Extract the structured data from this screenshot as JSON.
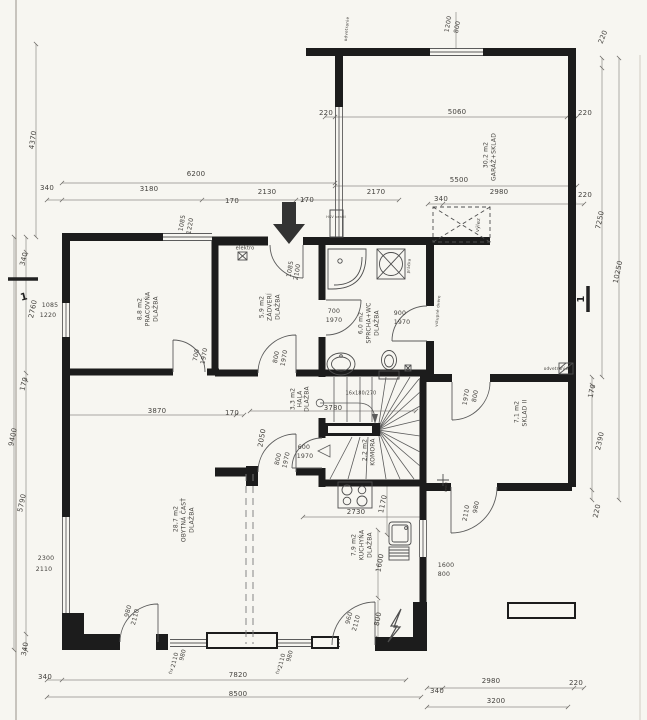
{
  "document": {
    "kind": "architectural-floor-plan"
  },
  "colors": {
    "paper": "#f7f6f1",
    "wall_ink": "#1c1c1c",
    "thin_line": "#5c5c5c",
    "dim_line": "#8f8d88",
    "text": "#44423e",
    "arrow": "#333333"
  },
  "labels": [
    {
      "name": "dim-1200-top",
      "kind": "dimension",
      "t": "1200",
      "x": 448,
      "y": 24,
      "r": -80,
      "s": 6.2
    },
    {
      "name": "dim-800-top",
      "kind": "dimension",
      "t": "800",
      "x": 457,
      "y": 27,
      "r": -80,
      "s": 6.2
    },
    {
      "name": "ann-odvetranie-top",
      "kind": "annotation",
      "t": "odvetranie",
      "x": 347,
      "y": 29,
      "r": -85,
      "s": 4.2
    },
    {
      "name": "dim-220-top-right",
      "kind": "dimension",
      "t": "220",
      "x": 603,
      "y": 37,
      "r": -68,
      "s": 7
    },
    {
      "name": "dim-4370",
      "kind": "dimension",
      "t": "4370",
      "x": 33,
      "y": 140,
      "r": -82,
      "s": 7
    },
    {
      "name": "dim-220-garage-left",
      "kind": "dimension",
      "t": "220",
      "x": 326,
      "y": 113,
      "r": 0,
      "s": 7
    },
    {
      "name": "dim-5060",
      "kind": "dimension",
      "t": "5060",
      "x": 457,
      "y": 112,
      "r": 0,
      "s": 7
    },
    {
      "name": "dim-220-garage-right",
      "kind": "dimension",
      "t": "220",
      "x": 585,
      "y": 113,
      "r": 0,
      "s": 7
    },
    {
      "name": "room-garaz-area",
      "kind": "room",
      "t": "30,2 m2",
      "x": 486,
      "y": 155,
      "r": -90,
      "s": 6
    },
    {
      "name": "room-garaz-name",
      "kind": "room",
      "t": "GARÁŽ+SKLAD",
      "x": 494,
      "y": 157,
      "r": -90,
      "s": 6
    },
    {
      "name": "dim-5500",
      "kind": "dimension",
      "t": "5500",
      "x": 459,
      "y": 180,
      "r": 0,
      "s": 7
    },
    {
      "name": "dim-6200",
      "kind": "dimension",
      "t": "6200",
      "x": 196,
      "y": 174,
      "r": 0,
      "s": 7
    },
    {
      "name": "dim-340-top-1",
      "kind": "dimension",
      "t": "340",
      "x": 47,
      "y": 188,
      "r": 0,
      "s": 7
    },
    {
      "name": "dim-3180",
      "kind": "dimension",
      "t": "3180",
      "x": 149,
      "y": 189,
      "r": 0,
      "s": 7
    },
    {
      "name": "dim-2130",
      "kind": "dimension",
      "t": "2130",
      "x": 267,
      "y": 192,
      "r": 0,
      "s": 7
    },
    {
      "name": "dim-170-top-1",
      "kind": "dimension",
      "t": "170",
      "x": 232,
      "y": 201,
      "r": 0,
      "s": 7
    },
    {
      "name": "dim-2170",
      "kind": "dimension",
      "t": "2170",
      "x": 376,
      "y": 192,
      "r": 0,
      "s": 7
    },
    {
      "name": "dim-170-top-2",
      "kind": "dimension",
      "t": "170",
      "x": 307,
      "y": 200,
      "r": 0,
      "s": 7
    },
    {
      "name": "dim-340-top-2",
      "kind": "dimension",
      "t": "340",
      "x": 441,
      "y": 199,
      "r": 0,
      "s": 7
    },
    {
      "name": "dim-2980-top",
      "kind": "dimension",
      "t": "2980",
      "x": 499,
      "y": 192,
      "r": 0,
      "s": 7
    },
    {
      "name": "dim-220-top-3",
      "kind": "dimension",
      "t": "220",
      "x": 585,
      "y": 195,
      "r": 0,
      "s": 7
    },
    {
      "name": "dim-7250",
      "kind": "dimension",
      "t": "7250",
      "x": 600,
      "y": 220,
      "r": -78,
      "s": 7
    },
    {
      "name": "dim-10250",
      "kind": "dimension",
      "t": "10250",
      "x": 618,
      "y": 272,
      "r": -78,
      "s": 7
    },
    {
      "name": "win-1085-top",
      "kind": "window-size",
      "t": "1085",
      "x": 182,
      "y": 223,
      "r": -80,
      "s": 6.2
    },
    {
      "name": "win-1220-top",
      "kind": "window-size",
      "t": "1220",
      "x": 190,
      "y": 226,
      "r": -80,
      "s": 6.2
    },
    {
      "name": "ann-hsv-ventil",
      "kind": "annotation",
      "t": "HSV ventil",
      "x": 336,
      "y": 217,
      "r": 0,
      "s": 3.4
    },
    {
      "name": "ann-vylez",
      "kind": "annotation",
      "t": "výlez",
      "x": 478,
      "y": 225,
      "r": -85,
      "s": 5
    },
    {
      "name": "ann-elektro",
      "kind": "annotation",
      "t": "elektro",
      "x": 245,
      "y": 248,
      "r": 0,
      "s": 5
    },
    {
      "name": "door-1085-vchod",
      "kind": "door-size",
      "t": "1085",
      "x": 290,
      "y": 269,
      "r": -80,
      "s": 6.2
    },
    {
      "name": "door-2100-vchod",
      "kind": "door-size",
      "t": "2100",
      "x": 297,
      "y": 272,
      "r": -80,
      "s": 6.2
    },
    {
      "name": "dim-340-left-1",
      "kind": "dimension",
      "t": "340",
      "x": 24,
      "y": 259,
      "r": -76,
      "s": 7
    },
    {
      "name": "dim-2760",
      "kind": "dimension",
      "t": "2760",
      "x": 33,
      "y": 309,
      "r": -78,
      "s": 7
    },
    {
      "name": "win-1085-left",
      "kind": "window-size",
      "t": "1085",
      "x": 50,
      "y": 305,
      "r": 0,
      "s": 6.2
    },
    {
      "name": "win-1220-left",
      "kind": "window-size",
      "t": "1220",
      "x": 48,
      "y": 315,
      "r": 0,
      "s": 6.2
    },
    {
      "name": "dim-170-left",
      "kind": "dimension",
      "t": "170",
      "x": 24,
      "y": 384,
      "r": -76,
      "s": 7
    },
    {
      "name": "dim-9400",
      "kind": "dimension",
      "t": "9400",
      "x": 13,
      "y": 437,
      "r": -78,
      "s": 7
    },
    {
      "name": "dim-5790",
      "kind": "dimension",
      "t": "5790",
      "x": 22,
      "y": 503,
      "r": -78,
      "s": 7
    },
    {
      "name": "win-2300-left",
      "kind": "window-size",
      "t": "2300",
      "x": 46,
      "y": 558,
      "r": 0,
      "s": 6.2
    },
    {
      "name": "win-2110-left",
      "kind": "window-size",
      "t": "2110",
      "x": 44,
      "y": 569,
      "r": 0,
      "s": 6.2
    },
    {
      "name": "dim-340-left-2",
      "kind": "dimension",
      "t": "340",
      "x": 25,
      "y": 649,
      "r": -80,
      "s": 7
    },
    {
      "name": "room-pracovna-area",
      "kind": "room",
      "t": "8,8 m2",
      "x": 140,
      "y": 309,
      "r": -90,
      "s": 6
    },
    {
      "name": "room-pracovna-name",
      "kind": "room",
      "t": "PRACOVŇA",
      "x": 148,
      "y": 309,
      "r": -90,
      "s": 6
    },
    {
      "name": "room-pracovna-floor",
      "kind": "room",
      "t": "DLAŽBA",
      "x": 156,
      "y": 309,
      "r": -90,
      "s": 6
    },
    {
      "name": "room-zadveri-area",
      "kind": "room",
      "t": "5,9 m2",
      "x": 262,
      "y": 307,
      "r": -90,
      "s": 6
    },
    {
      "name": "room-zadveri-name",
      "kind": "room",
      "t": "ZÁDVERÍ",
      "x": 270,
      "y": 307,
      "r": -90,
      "s": 6
    },
    {
      "name": "room-zadveri-floor",
      "kind": "room",
      "t": "DLAŽBA",
      "x": 278,
      "y": 307,
      "r": -90,
      "s": 6
    },
    {
      "name": "room-sprcha-area",
      "kind": "room",
      "t": "6,0 m2",
      "x": 361,
      "y": 323,
      "r": -90,
      "s": 6
    },
    {
      "name": "room-sprcha-name",
      "kind": "room",
      "t": "SPRCHA+WC",
      "x": 369,
      "y": 323,
      "r": -90,
      "s": 6
    },
    {
      "name": "room-sprcha-floor",
      "kind": "room",
      "t": "DLAŽBA",
      "x": 377,
      "y": 323,
      "r": -90,
      "s": 6
    },
    {
      "name": "ann-pracka",
      "kind": "annotation",
      "t": "práčka",
      "x": 409,
      "y": 266,
      "r": -85,
      "s": 4
    },
    {
      "name": "door-700-sprcha",
      "kind": "door-size",
      "t": "700",
      "x": 334,
      "y": 311,
      "r": 0,
      "s": 6.2
    },
    {
      "name": "door-1970-sprcha",
      "kind": "door-size",
      "t": "1970",
      "x": 334,
      "y": 320,
      "r": 0,
      "s": 6.2
    },
    {
      "name": "door-900-vstup",
      "kind": "door-size",
      "t": "900",
      "x": 400,
      "y": 313,
      "r": 0,
      "s": 6.2
    },
    {
      "name": "door-1970-vstup",
      "kind": "door-size",
      "t": "1970",
      "x": 402,
      "y": 322,
      "r": 0,
      "s": 6.2
    },
    {
      "name": "ann-vstupne-dvere",
      "kind": "annotation",
      "t": "vstupné dvere",
      "x": 438,
      "y": 311,
      "r": -85,
      "s": 4
    },
    {
      "name": "door-700-pracovna",
      "kind": "door-size",
      "t": "700",
      "x": 196,
      "y": 355,
      "r": -80,
      "s": 6.2
    },
    {
      "name": "door-1970-pracovna",
      "kind": "door-size",
      "t": "1970",
      "x": 204,
      "y": 356,
      "r": -80,
      "s": 6.2
    },
    {
      "name": "door-800-zadveri",
      "kind": "door-size",
      "t": "800",
      "x": 276,
      "y": 357,
      "r": -80,
      "s": 6.2
    },
    {
      "name": "door-1970-zadveri",
      "kind": "door-size",
      "t": "1970",
      "x": 284,
      "y": 358,
      "r": -80,
      "s": 6.2
    },
    {
      "name": "room-hala-area",
      "kind": "room",
      "t": "3,3 m2",
      "x": 293,
      "y": 399,
      "r": -90,
      "s": 6
    },
    {
      "name": "room-hala-name",
      "kind": "room",
      "t": "HALA",
      "x": 300,
      "y": 399,
      "r": -90,
      "s": 6
    },
    {
      "name": "room-hala-floor",
      "kind": "room",
      "t": "DLAŽBA",
      "x": 307,
      "y": 399,
      "r": -90,
      "s": 6
    },
    {
      "name": "dim-3870",
      "kind": "dimension",
      "t": "3870",
      "x": 157,
      "y": 411,
      "r": 0,
      "s": 7
    },
    {
      "name": "dim-170-hala",
      "kind": "dimension",
      "t": "170",
      "x": 232,
      "y": 413,
      "r": 0,
      "s": 7
    },
    {
      "name": "ann-stair-spec",
      "kind": "annotation",
      "t": "16x180/270",
      "x": 361,
      "y": 393,
      "r": 0,
      "s": 4.8
    },
    {
      "name": "dim-3780",
      "kind": "dimension",
      "t": "3780",
      "x": 333,
      "y": 408,
      "r": 0,
      "s": 7
    },
    {
      "name": "door-1970-sklad-n",
      "kind": "door-size",
      "t": "1970",
      "x": 466,
      "y": 397,
      "r": -80,
      "s": 6.2
    },
    {
      "name": "door-800-sklad-n",
      "kind": "door-size",
      "t": "800",
      "x": 475,
      "y": 396,
      "r": -80,
      "s": 6.2
    },
    {
      "name": "room-sklad2-area",
      "kind": "room",
      "t": "7,1 m2",
      "x": 517,
      "y": 412,
      "r": -90,
      "s": 6
    },
    {
      "name": "room-sklad2-name",
      "kind": "room",
      "t": "SKLAD II",
      "x": 525,
      "y": 413,
      "r": -90,
      "s": 6
    },
    {
      "name": "ann-odvetranie-right",
      "kind": "annotation",
      "t": "odvetranie",
      "x": 556,
      "y": 369,
      "r": 0,
      "s": 4.2,
      "a": "end"
    },
    {
      "name": "dim-170-right",
      "kind": "dimension",
      "t": "170",
      "x": 592,
      "y": 391,
      "r": -78,
      "s": 7
    },
    {
      "name": "dim-2390",
      "kind": "dimension",
      "t": "2390",
      "x": 600,
      "y": 441,
      "r": -78,
      "s": 7
    },
    {
      "name": "dim-220-right",
      "kind": "dimension",
      "t": "220",
      "x": 597,
      "y": 511,
      "r": -78,
      "s": 7
    },
    {
      "name": "dim-2050",
      "kind": "dimension",
      "t": "2050",
      "x": 262,
      "y": 438,
      "r": -80,
      "s": 7
    },
    {
      "name": "door-800-obytna",
      "kind": "door-size",
      "t": "800",
      "x": 278,
      "y": 459,
      "r": -78,
      "s": 6.2
    },
    {
      "name": "door-1970-obytna",
      "kind": "door-size",
      "t": "1970",
      "x": 286,
      "y": 460,
      "r": -78,
      "s": 6.2
    },
    {
      "name": "door-600-komora",
      "kind": "door-size",
      "t": "600",
      "x": 304,
      "y": 447,
      "r": 0,
      "s": 6.2
    },
    {
      "name": "door-1970-komora",
      "kind": "door-size",
      "t": "1970",
      "x": 305,
      "y": 456,
      "r": 0,
      "s": 6.2
    },
    {
      "name": "room-komora-area",
      "kind": "room",
      "t": "2,2 m2",
      "x": 365,
      "y": 450,
      "r": -90,
      "s": 6
    },
    {
      "name": "room-komora-name",
      "kind": "room",
      "t": "KOMORA",
      "x": 373,
      "y": 452,
      "r": -90,
      "s": 6
    },
    {
      "name": "room-obytna-area",
      "kind": "room",
      "t": "28,7 m2",
      "x": 176,
      "y": 519,
      "r": -90,
      "s": 6
    },
    {
      "name": "room-obytna-name",
      "kind": "room",
      "t": "OBYTNÁ ČASŤ",
      "x": 184,
      "y": 520,
      "r": -90,
      "s": 6
    },
    {
      "name": "room-obytna-floor",
      "kind": "room",
      "t": "DLAŽBA",
      "x": 192,
      "y": 520,
      "r": -90,
      "s": 6
    },
    {
      "name": "door-2110-sklad-s",
      "kind": "door-size",
      "t": "2110",
      "x": 466,
      "y": 513,
      "r": -80,
      "s": 6.2
    },
    {
      "name": "door-980-sklad-s",
      "kind": "door-size",
      "t": "980",
      "x": 476,
      "y": 507,
      "r": -80,
      "s": 6.2
    },
    {
      "name": "ann-ventil",
      "kind": "annotation",
      "t": "ventil",
      "x": 446,
      "y": 487,
      "r": -85,
      "s": 3.4
    },
    {
      "name": "dim-1170",
      "kind": "dimension",
      "t": "1170",
      "x": 383,
      "y": 504,
      "r": -78,
      "s": 7
    },
    {
      "name": "dim-2730",
      "kind": "dimension",
      "t": "2730",
      "x": 356,
      "y": 512,
      "r": 0,
      "s": 7
    },
    {
      "name": "room-kuchyna-area",
      "kind": "room",
      "t": "7,9 m2",
      "x": 354,
      "y": 545,
      "r": -90,
      "s": 6
    },
    {
      "name": "room-kuchyna-name",
      "kind": "room",
      "t": "KUCHYŇA",
      "x": 362,
      "y": 545,
      "r": -90,
      "s": 6
    },
    {
      "name": "room-kuchyna-floor",
      "kind": "room",
      "t": "DLAŽBA",
      "x": 370,
      "y": 545,
      "r": -90,
      "s": 6
    },
    {
      "name": "win-1600-kuchyna",
      "kind": "window-size",
      "t": "1600",
      "x": 446,
      "y": 565,
      "r": 0,
      "s": 6.2
    },
    {
      "name": "win-800-kuchyna",
      "kind": "window-size",
      "t": "800",
      "x": 444,
      "y": 574,
      "r": 0,
      "s": 6.2
    },
    {
      "name": "dim-1600-v",
      "kind": "dimension",
      "t": "1600",
      "x": 380,
      "y": 563,
      "r": -80,
      "s": 7
    },
    {
      "name": "dim-800-v",
      "kind": "dimension",
      "t": "800",
      "x": 378,
      "y": 619,
      "r": -80,
      "s": 7
    },
    {
      "name": "door-960-kuchyna",
      "kind": "door-size",
      "t": "960",
      "x": 349,
      "y": 618,
      "r": -76,
      "s": 6.2
    },
    {
      "name": "door-2110-kuchyna",
      "kind": "door-size",
      "t": "2110",
      "x": 356,
      "y": 623,
      "r": -76,
      "s": 6.2
    },
    {
      "name": "door-980-obytna",
      "kind": "door-size",
      "t": "980",
      "x": 128,
      "y": 611,
      "r": -76,
      "s": 6.2
    },
    {
      "name": "door-2110-obytna",
      "kind": "door-size",
      "t": "2110",
      "x": 135,
      "y": 617,
      "r": -76,
      "s": 6.2
    },
    {
      "name": "win-980-fix-1",
      "kind": "window-size",
      "t": "980",
      "x": 183,
      "y": 655,
      "r": -76,
      "s": 5.8
    },
    {
      "name": "win-2110-fix-1",
      "kind": "window-size",
      "t": "2110",
      "x": 175,
      "y": 660,
      "r": -76,
      "s": 5.8
    },
    {
      "name": "win-fix-1",
      "kind": "window-size",
      "t": "fix",
      "x": 171,
      "y": 671,
      "r": -76,
      "s": 4.5
    },
    {
      "name": "win-980-fix-2",
      "kind": "window-size",
      "t": "980",
      "x": 290,
      "y": 656,
      "r": -76,
      "s": 5.8
    },
    {
      "name": "win-2110-fix-2",
      "kind": "window-size",
      "t": "2110",
      "x": 282,
      "y": 661,
      "r": -76,
      "s": 5.8
    },
    {
      "name": "win-fix-2",
      "kind": "window-size",
      "t": "fix",
      "x": 278,
      "y": 671,
      "r": -76,
      "s": 4.5
    },
    {
      "name": "dim-340-bottom-1",
      "kind": "dimension",
      "t": "340",
      "x": 45,
      "y": 677,
      "r": 0,
      "s": 7
    },
    {
      "name": "dim-7820",
      "kind": "dimension",
      "t": "7820",
      "x": 238,
      "y": 675,
      "r": 0,
      "s": 7
    },
    {
      "name": "dim-8500",
      "kind": "dimension",
      "t": "8500",
      "x": 238,
      "y": 694,
      "r": 0,
      "s": 7
    },
    {
      "name": "dim-340-bottom-2",
      "kind": "dimension",
      "t": "340",
      "x": 437,
      "y": 691,
      "r": 0,
      "s": 7
    },
    {
      "name": "dim-2980-bottom",
      "kind": "dimension",
      "t": "2980",
      "x": 491,
      "y": 681,
      "r": 0,
      "s": 7
    },
    {
      "name": "dim-220-bottom",
      "kind": "dimension",
      "t": "220",
      "x": 576,
      "y": 683,
      "r": 0,
      "s": 7
    },
    {
      "name": "dim-3200",
      "kind": "dimension",
      "t": "3200",
      "x": 496,
      "y": 701,
      "r": 0,
      "s": 7
    },
    {
      "name": "section-mark-1-left",
      "kind": "section",
      "t": "1",
      "x": 24,
      "y": 297,
      "r": -14,
      "s": 10
    },
    {
      "name": "section-mark-1-right",
      "kind": "section",
      "t": "1",
      "x": 581,
      "y": 299,
      "r": -90,
      "s": 10
    }
  ]
}
